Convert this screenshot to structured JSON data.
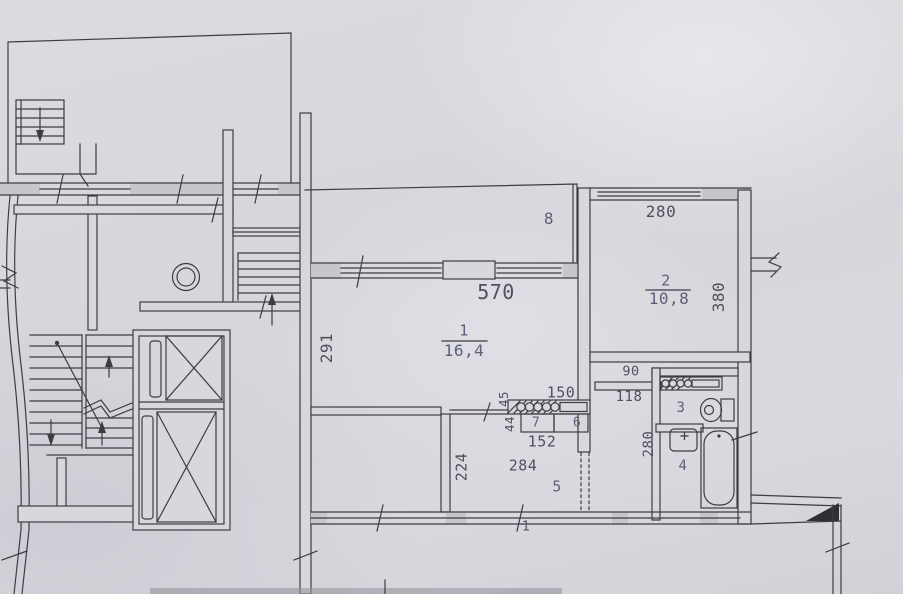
{
  "document": {
    "type": "scanned apartment floor plan (BTI style)"
  },
  "colors": {
    "paper": "#d8d7dc",
    "ink": "#3c3c43",
    "wall_fill": "#c7c6cd",
    "room_label": "#5c6078",
    "dim_label": "#4e515e"
  },
  "rooms": {
    "r1n": "1",
    "r1a": "16,4",
    "r2n": "2",
    "r2a": "10,8",
    "r3": "3",
    "r4": "4",
    "r5": "5",
    "r6": "6",
    "r7": "7",
    "r8": "8"
  },
  "dims": {
    "d570": "570",
    "d291": "291",
    "d280_top": "280",
    "d380": "380",
    "d90": "90",
    "d118": "118",
    "d150": "150",
    "d45": "45",
    "d44": "44",
    "d152": "152",
    "d284": "284",
    "d224": "224",
    "d280_bath": "280",
    "d1": "1"
  }
}
